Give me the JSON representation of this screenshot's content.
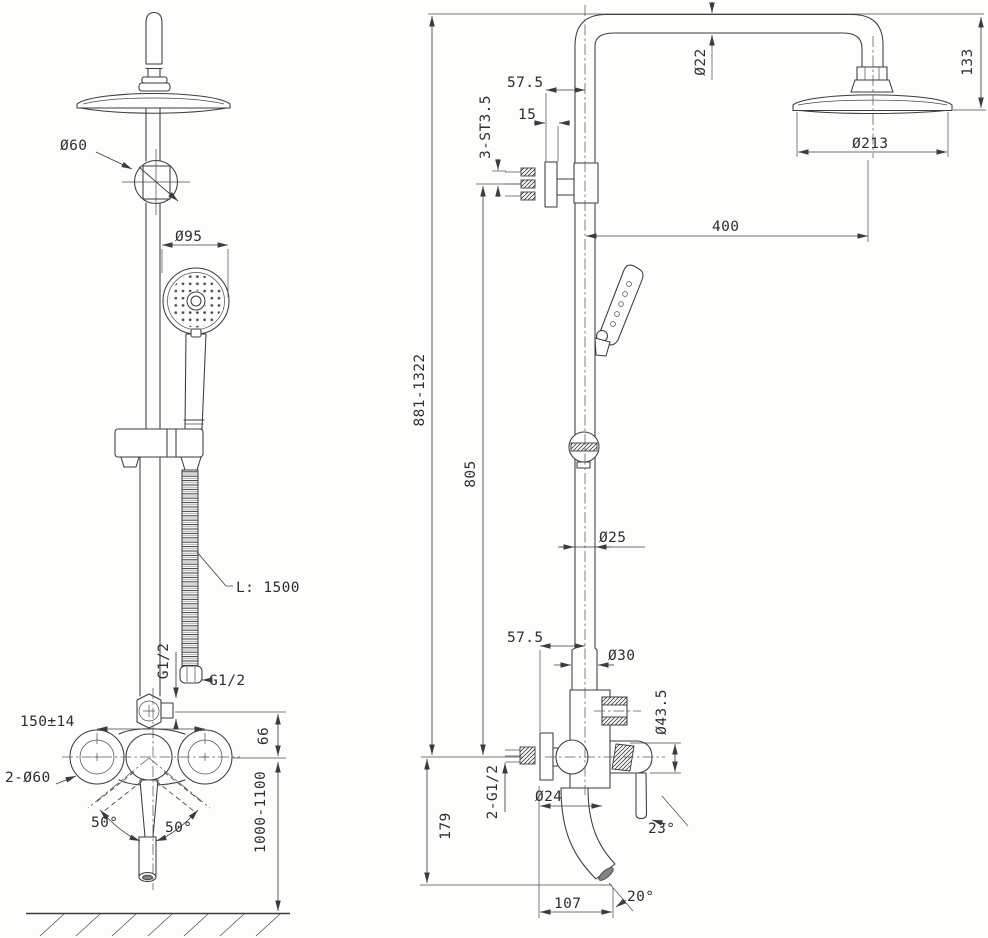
{
  "drawing": {
    "type": "technical-drawing",
    "subject": "Shower column with hand shower and mixer - front and side elevations",
    "colors": {
      "line": "#3c3c3c",
      "background": "#fdfdfc",
      "text": "#2e2e2e"
    },
    "front": {
      "d60": "Ø60",
      "d95": "Ø95",
      "hose": "L: 1500",
      "g12_hose": "G1/2",
      "g12_outlet": "G1/2",
      "spread": "150±14",
      "flanges": "2-Ø60",
      "offset": "66",
      "height": "1000-1100",
      "swing_l": "50°",
      "swing_r": "50°"
    },
    "side": {
      "overall": "881-1322",
      "riser": "805",
      "d22": "Ø22",
      "drop": "133",
      "d213": "Ø213",
      "reach": "400",
      "off_top": "57.5",
      "depth": "15",
      "screws": "3-ST3.5",
      "d25": "Ø25",
      "off_bot": "57.5",
      "d30": "Ø30",
      "d435": "Ø43.5",
      "inlets": "2-G1/2",
      "d24": "Ø24",
      "a23": "23°",
      "drop2": "179",
      "reach2": "107",
      "a20": "20°"
    }
  }
}
